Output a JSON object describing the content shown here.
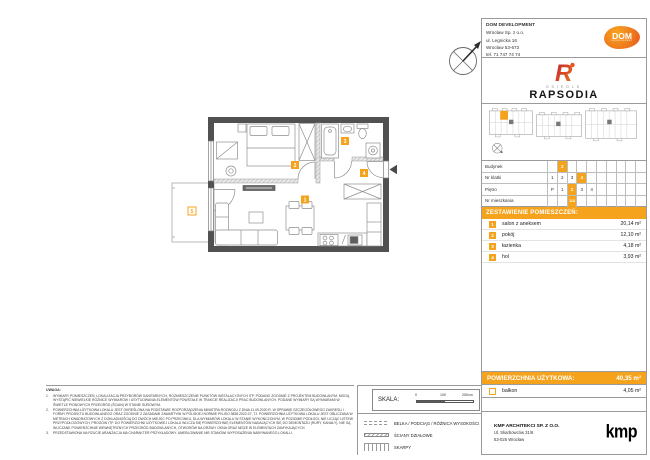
{
  "developer": {
    "name": "DOM DEVELOPMENT",
    "line1": "Wrocław Sp. z o.o.",
    "line2": "ul. Legnicka 16",
    "line3": "Wrocław 53-673",
    "line4": "tel. 71 747 74 74",
    "logo_text": "DOM",
    "logo_sub": "DEVELOPMENT"
  },
  "estate": {
    "small": "OSIEDLE",
    "name": "RAPSODIA",
    "logo_letter": "R"
  },
  "unit_info": {
    "rows": [
      {
        "label": "Budynek",
        "cells": [
          "",
          "2",
          "",
          "",
          "",
          "",
          "",
          "",
          "",
          ""
        ],
        "hl": [
          1
        ]
      },
      {
        "label": "Nr klatki",
        "cells": [
          "1",
          "2",
          "3",
          "4",
          "",
          "",
          "",
          "",
          "",
          ""
        ],
        "hl": [
          3
        ]
      },
      {
        "label": "Piętro",
        "cells": [
          "P",
          "1",
          "2",
          "3",
          "4",
          "",
          "",
          "",
          "",
          ""
        ],
        "hl": [
          2
        ]
      },
      {
        "label": "Nr mieszkania",
        "cells": [
          "",
          "",
          "118",
          "",
          "",
          "",
          "",
          "",
          "",
          ""
        ],
        "hl": [
          2
        ]
      }
    ]
  },
  "rooms_header": "ZESTAWIENIE POMIESZCZEŃ:",
  "rooms": [
    {
      "nr": "1",
      "name": "salon z aneksem",
      "area": "20,14  m²"
    },
    {
      "nr": "2",
      "name": "pokój",
      "area": "12,10  m²"
    },
    {
      "nr": "3",
      "name": "łazienka",
      "area": "4,18  m²"
    },
    {
      "nr": "4",
      "name": "hol",
      "area": "3,93  m²"
    }
  ],
  "total": {
    "label": "POWIERZCHNIA UŻYTKOWA:",
    "value": "40,35  m²"
  },
  "balcony": {
    "nr": "5",
    "name": "balkon",
    "area": "4,05  m²"
  },
  "plan": {
    "labels": [
      "1",
      "2",
      "3",
      "4",
      "5"
    ],
    "north": "N"
  },
  "scale": {
    "label": "SKALA:",
    "t0": "0",
    "t1": "100",
    "t2": "200cm"
  },
  "legend": {
    "items": [
      {
        "icon": "icon-beam",
        "label": "BELKA / PODCIĄG / RÓŻNICA WYSOKOŚCI"
      },
      {
        "icon": "icon-hatch",
        "label": "ŚCIANY DZIAŁOWE"
      },
      {
        "icon": "icon-ticks",
        "label": "SKARPY"
      }
    ]
  },
  "uwaga": {
    "title": "UWAGA:",
    "items": [
      "WYMIARY POMIESZCZEŃ, LOKALIZACJA PRZYBORÓW SANITARNYCH, ROZMIESZCZENIE PUNKTÓW INSTALACYJNYCH ITP. PODANO ZGODNIE Z PROJEKTEM BUDOWLANYM. MOGĄ WYSTĄPIĆ NIEWIELKIE RÓŻNICE WYMIARÓW I USYTUOWANIA ELEMENTÓW POWSTAŁE W TRAKCIE REALIZACJI PRAC BUDOWLANYCH. PODANE WYMIARY SĄ WYMIARAMI W ŚWIETLE PIONOWYCH PRZEGRÓD (ŚCIAN) W STANIE SUROWYM.",
      "POWIERZCHNIA UŻYTKOWA LOKALU JEST OKREŚLONA NA PODSTAWIE ROZPORZĄDZENIA MINISTRA ROZWOJU Z DNIA 11.09.2020 R. W SPRAWIE SZCZEGÓŁOWEGO ZAKRESU I FORMY PROJEKTU BUDOWLANEGO ORAZ ZGODNIE Z ZASADAMI ZAWARTYMI W POLSKIEJ NORMIE PN-ISO 9836:2022-07, TJ. POWIERZCHNIA UŻYTKOWA LOKALU JEST OBLICZANA W METRACH KWADRATOWYCH Z DOKŁADNOŚCIĄ DO DWÓCH MIEJSC PO PRZECINKU, DLA WYMIARÓW LOKALU W STANIE WYKOŃCZONYM, W POZIOMIE PODŁOGI, NIE LICZĄC LISTEW PRZYPODŁOGOWYCH, PROGÓW ITP. DO POWIERZCHNI UŻYTKOWEJ LOKALU WLICZA SIĘ POWIERZCHNIĘ ELEMENTÓW NADAJĄCYCH SIĘ DO DEMONTAŻU (RURY, KANAŁY). NIE SĄ WLICZANE POWIERZCHNIE WEWNĘTRZNYCH PRZEGRÓD BUDOWLANYCH, OTWORÓW NA DRZWI I OKNA ORAZ NISZE W ELEMENTACH ZAMYKAJĄCYCH.",
      "PRZEDSTAWIONA NA RZUCIE ARANŻACJA MA CHARAKTER PRZYKŁADOWY. UMEBLOWANIE NIE STANOWI WYPOSAŻENIA NABYWANEGO LOKALU."
    ]
  },
  "architect": {
    "name": "KMP ARCHITEKCI SP. Z O.O.",
    "address1": "Ul. Skarbowców 31/6",
    "address2": "53-025 Wrocław",
    "logo": "kmp"
  },
  "colors": {
    "accent": "#F5A31C",
    "wall": "#515151"
  }
}
